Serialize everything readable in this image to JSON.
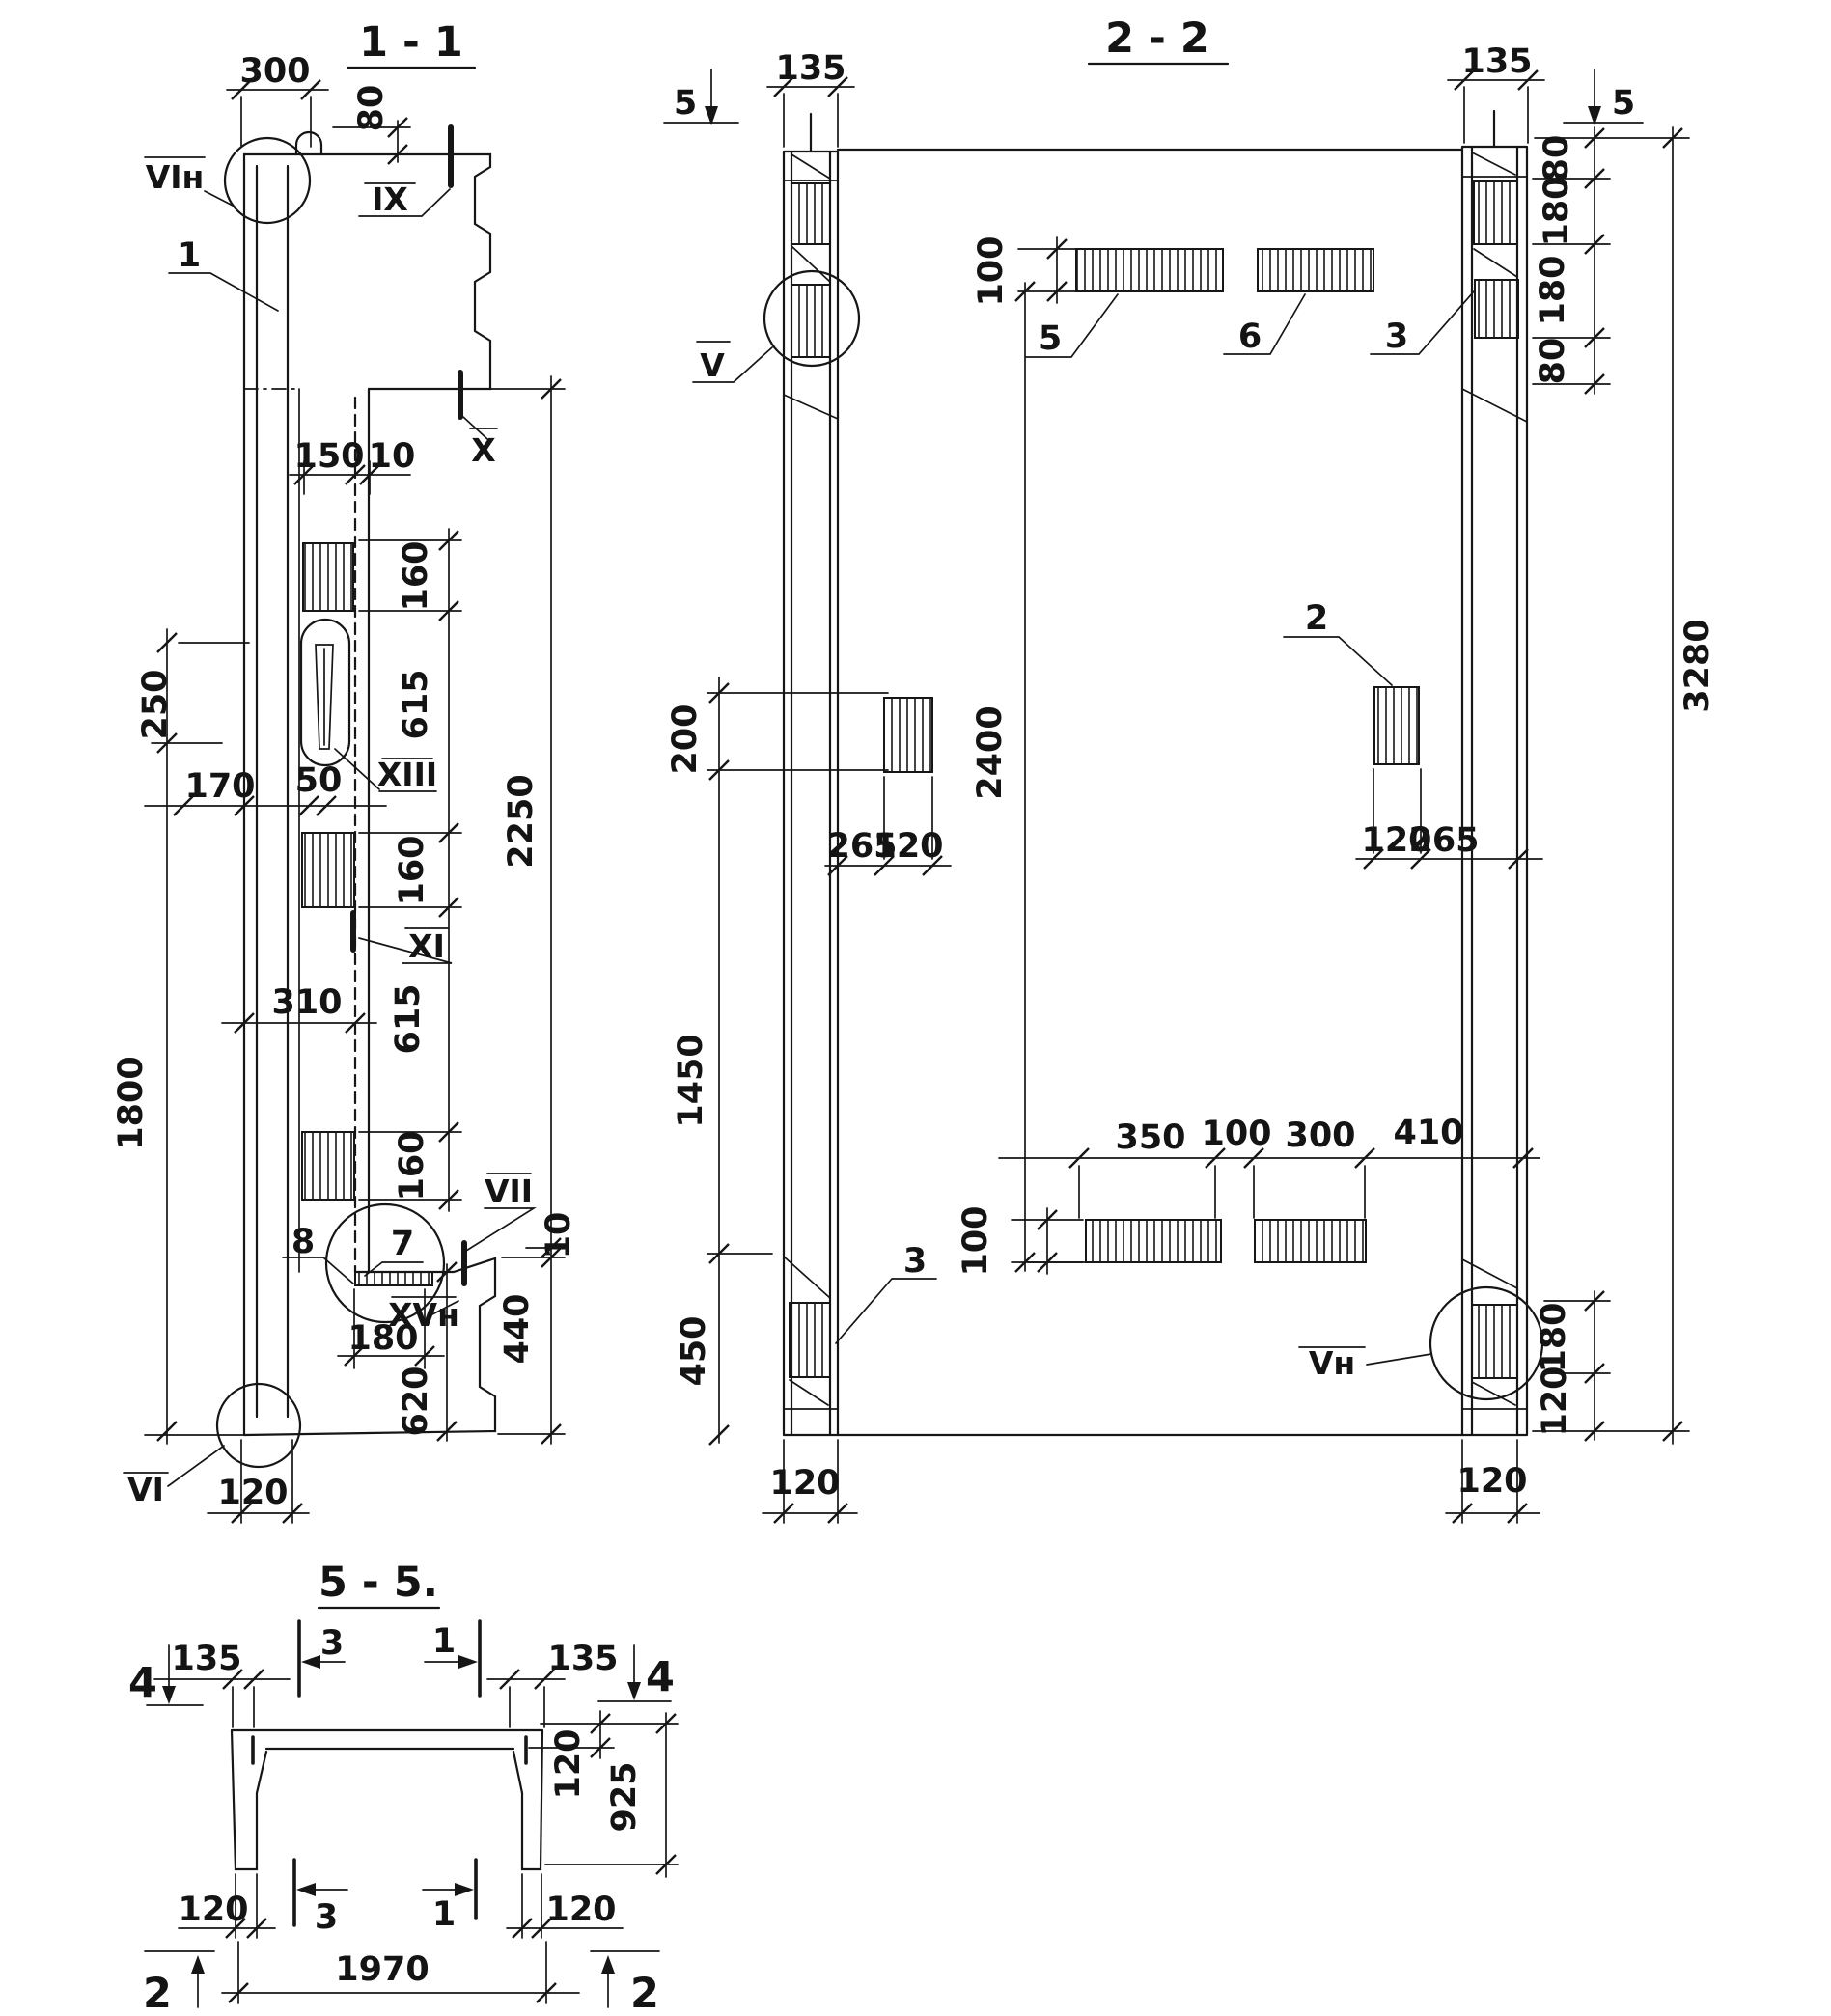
{
  "drawing": {
    "s11": {
      "title": "1 - 1",
      "d300": "300",
      "d80": "80",
      "d150": "150",
      "d10a": "10",
      "d160a": "160",
      "d615a": "615",
      "d160b": "160",
      "d615b": "615",
      "d160c": "160",
      "d2250": "2250",
      "d250": "250",
      "d1800": "1800",
      "d170": "170",
      "d50": "50",
      "d310": "310",
      "d180": "180",
      "d620": "620",
      "d440": "440",
      "d10b": "10",
      "d120": "120",
      "mVIn": "VIн",
      "mIX": "IX",
      "mX": "X",
      "mXIII": "XIII",
      "mXI": "XI",
      "mVII": "VII",
      "mXVn": "XVн",
      "mVI": "VI",
      "p1": "1",
      "p7": "7",
      "p8": "8"
    },
    "s22": {
      "title": "2 - 2",
      "cut5a": "5",
      "cut5b": "5",
      "d135L": "135",
      "d135R": "135",
      "d80a": "80",
      "d180a": "180",
      "d180b": "180",
      "d80b": "80",
      "d3280": "3280",
      "d100a": "100",
      "d200": "200",
      "d2400": "2400",
      "d265L": "265",
      "d120La": "120",
      "d120Ra": "120",
      "d265R": "265",
      "d1450": "1450",
      "d450": "450",
      "d350": "350",
      "d100b": "100",
      "d300": "300",
      "d410": "410",
      "d100c": "100",
      "d180c": "180",
      "d120Rb": "120",
      "d120botL": "120",
      "d120botR": "120",
      "mV": "V",
      "mVn": "Vн",
      "p5": "5",
      "p6": "6",
      "p3a": "3",
      "p2": "2",
      "p3b": "3"
    },
    "s55": {
      "title": "5 - 5.",
      "cut4a": "4",
      "cut4b": "4",
      "cut3a": "3",
      "cut1a": "1",
      "cut3b": "3",
      "cut1b": "1",
      "cut2a": "2",
      "cut2b": "2",
      "d135L": "135",
      "d135R": "135",
      "d120fl": "120",
      "d925": "925",
      "d120botL": "120",
      "d120botR": "120",
      "d1970": "1970"
    }
  }
}
